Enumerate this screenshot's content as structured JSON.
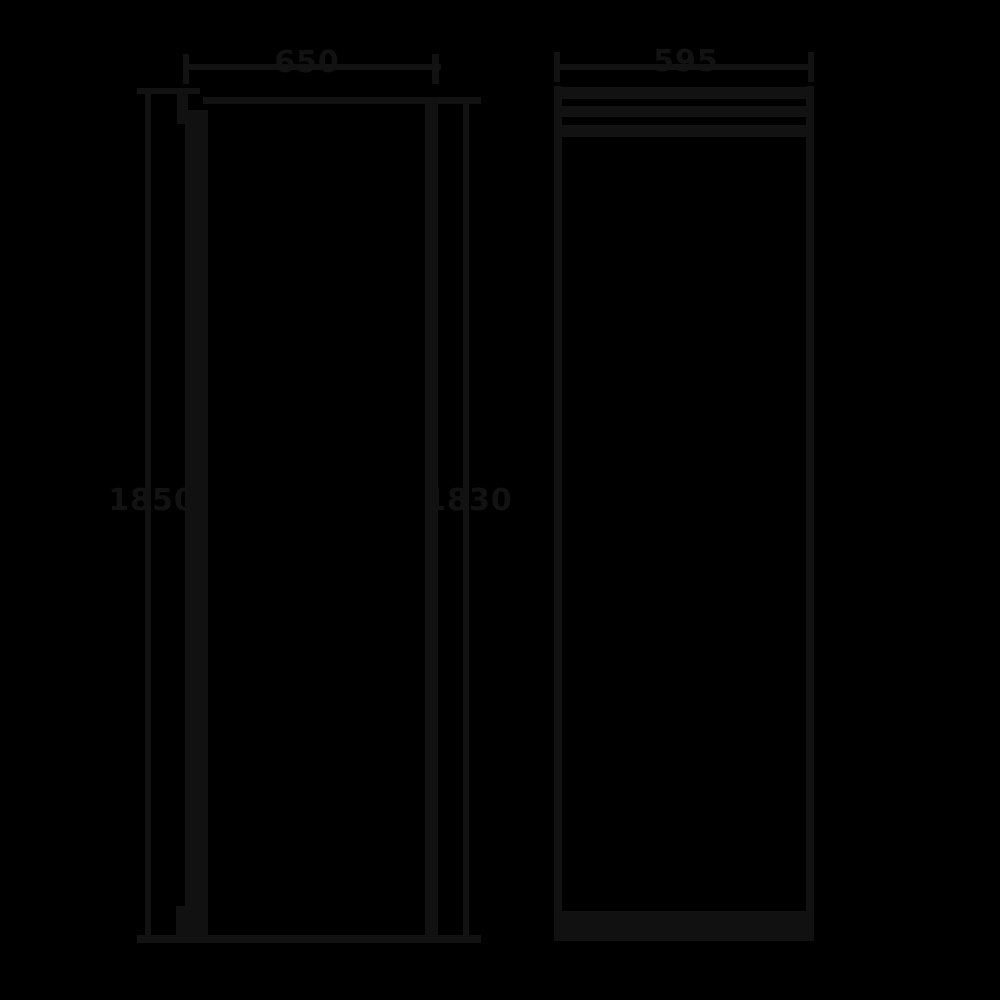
{
  "drawing": {
    "description": "Appliance dimension drawing, two orthographic views on black background",
    "colors": {
      "background": "#000000",
      "line": "#121212",
      "text": "#121212"
    },
    "views": {
      "side_view": {
        "name": "Side view",
        "labels": {
          "depth_top": "650",
          "height_left": "1850",
          "height_right": "1830"
        }
      },
      "front_view": {
        "name": "Front view",
        "labels": {
          "width_top": "595"
        }
      }
    }
  }
}
